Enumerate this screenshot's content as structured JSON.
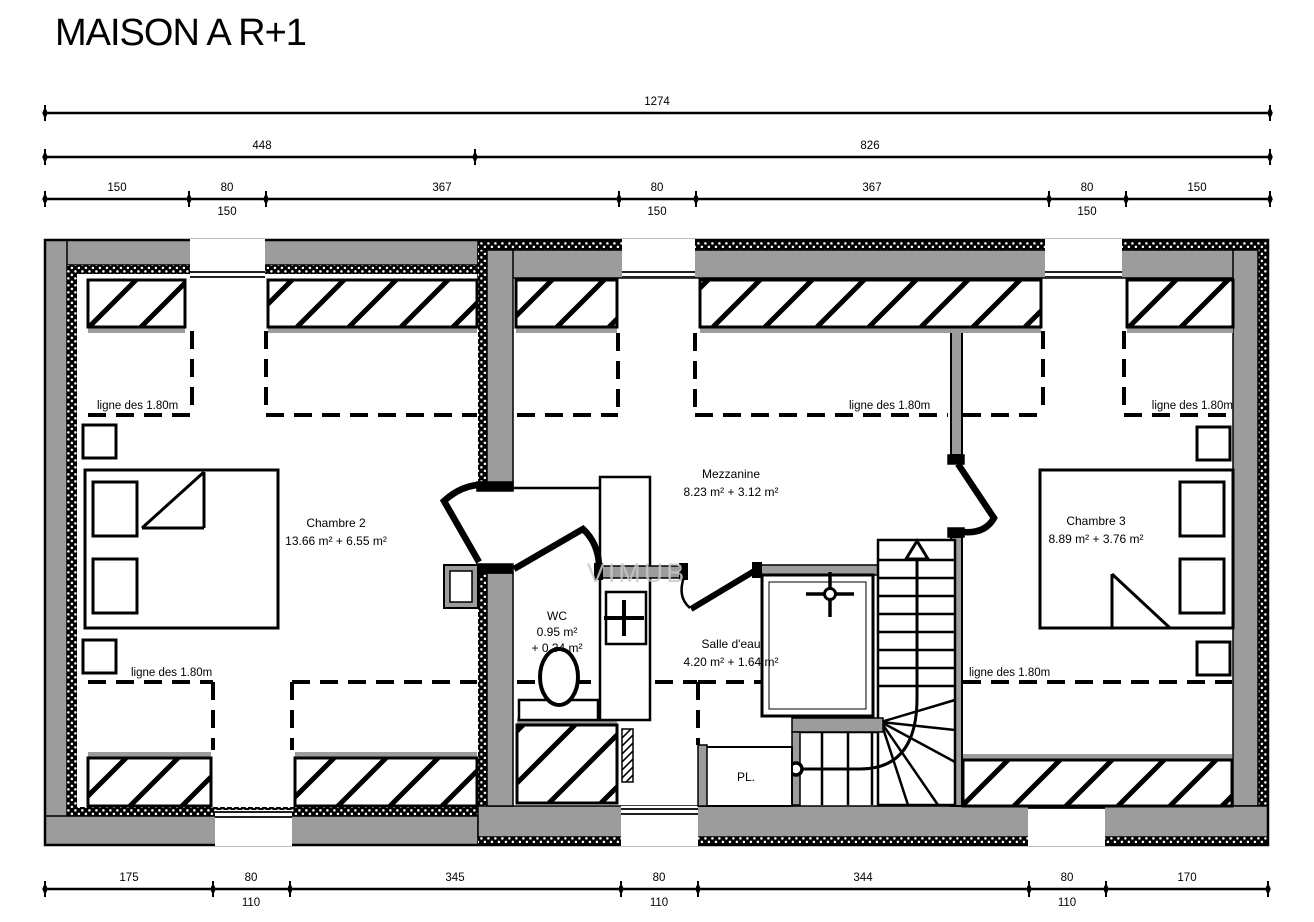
{
  "title": "MAISON A R+1",
  "watermark": "VIMUB",
  "annotations": {
    "height_line": "ligne des 1.80m"
  },
  "dimensions": {
    "top_total": "1274",
    "top_sections": [
      "448",
      "826"
    ],
    "top_chain": [
      "150",
      "80",
      "367",
      "80",
      "367",
      "80",
      "150"
    ],
    "top_window_widths": [
      "150",
      "150",
      "150"
    ],
    "bottom_chain": [
      "175",
      "80",
      "345",
      "80",
      "344",
      "80",
      "170"
    ],
    "bottom_window_widths": [
      "110",
      "110",
      "110"
    ]
  },
  "rooms": {
    "chambre2": {
      "name": "Chambre 2",
      "area": "13.66 m² + 6.55 m²"
    },
    "mezzanine": {
      "name": "Mezzanine",
      "area": "8.23 m² + 3.12 m²"
    },
    "chambre3": {
      "name": "Chambre 3",
      "area": "8.89 m² + 3.76 m²"
    },
    "wc": {
      "name": "WC",
      "area": "0.95 m²",
      "area_extra": "+ 0.34 m²"
    },
    "salle_eau": {
      "name": "Salle d'eau",
      "area": "4.20 m² + 1.64 m²"
    },
    "placard": {
      "name": "PL."
    }
  },
  "colors": {
    "wall_gray": "#9c9c9c",
    "line_black": "#000000"
  }
}
